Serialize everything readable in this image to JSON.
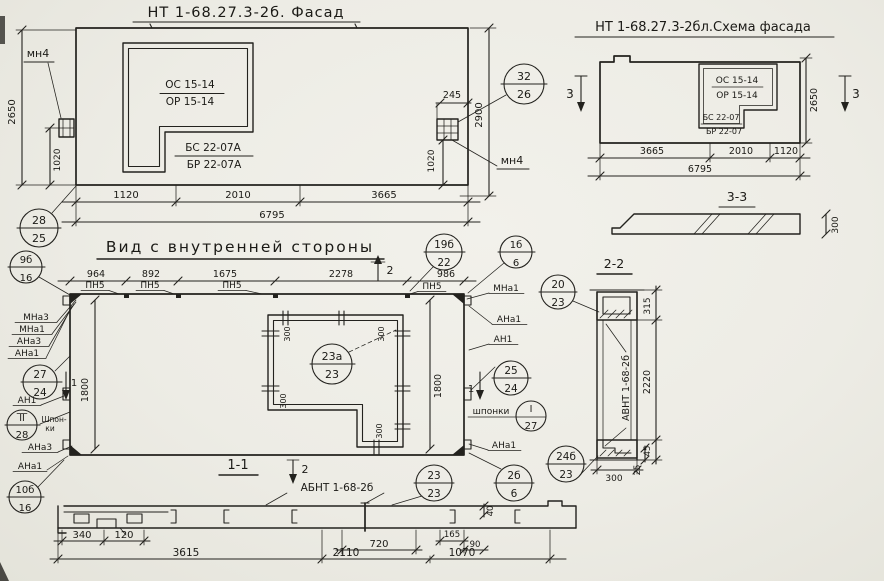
{
  "palette": {
    "paper": "#edece5",
    "ink": "#23221e"
  },
  "facade": {
    "title": "НТ 1-68.27.3-2б. Фасад",
    "os": "ОС 15-14",
    "or": "ОР 15-14",
    "bs": "БС 22-07А",
    "br": "БР 22-07А",
    "mn4": "мн4",
    "h_left": "2650",
    "h_right": "2900",
    "a_left": "1020",
    "a_right": "1020",
    "a_off": "245",
    "b1": "1120",
    "b2": "2010",
    "b3": "3665",
    "total": "6795",
    "c28": "28",
    "c25": "25",
    "c32": "32",
    "c26": "26"
  },
  "schema": {
    "title": "НТ 1-68.27.3-2бл.Схема фасада",
    "os": "ОС 15-14",
    "or": "ОР 15-14",
    "bs": "БС 22-07",
    "br": "БР 22-07",
    "h": "2650",
    "mark": "3",
    "b1": "3665",
    "b2": "2010",
    "b3": "1120",
    "total": "6795",
    "sec": "3-3",
    "sec_h": "300"
  },
  "inner": {
    "title": "Вид с внутренней стороны",
    "d1": "964",
    "d2": "892",
    "d3": "1675",
    "d4": "2278",
    "d5": "986",
    "pn": "ПН5",
    "mark2": "2",
    "mark1": "1",
    "c19t": "19б",
    "c19b": "22",
    "c9t": "9б",
    "c9b": "16",
    "c1t": "1б",
    "c1b": "6",
    "mna3": "МНа3",
    "mna1": "МНа1",
    "ana3": "АНа3",
    "ana1": "АНа1",
    "an1": "АН1",
    "c27t": "27",
    "c27b": "24",
    "cIIt": "II",
    "cIIb": "28",
    "shp1": "Шпон-",
    "shp2": "ки",
    "v1800": "1800",
    "w300": "300",
    "c23at": "23а",
    "c23ab": "23",
    "c25t": "25",
    "c25b": "24",
    "shponki": "шпонки",
    "cIt": "I",
    "cIb": "27",
    "c10t": "10б",
    "c10b": "16",
    "sec": "1-1"
  },
  "sec11": {
    "label": "АБНТ 1-68-2б",
    "mark2": "2",
    "c23t": "23",
    "c23b": "23",
    "c2bt": "2б",
    "c2bb": "6",
    "d340": "340",
    "d120": "120",
    "d720": "720",
    "d165": "165",
    "d90": "90",
    "d40": "40",
    "d3615": "3615",
    "d2110": "2110",
    "d1070": "1070"
  },
  "sec22": {
    "title": "2-2",
    "label": "АВНТ 1-68-2б",
    "c20t": "20",
    "c20b": "23",
    "c24t": "24б",
    "c24b": "23",
    "d315": "315",
    "d2220": "2220",
    "d45": "45",
    "d25": "25",
    "d300": "300"
  }
}
